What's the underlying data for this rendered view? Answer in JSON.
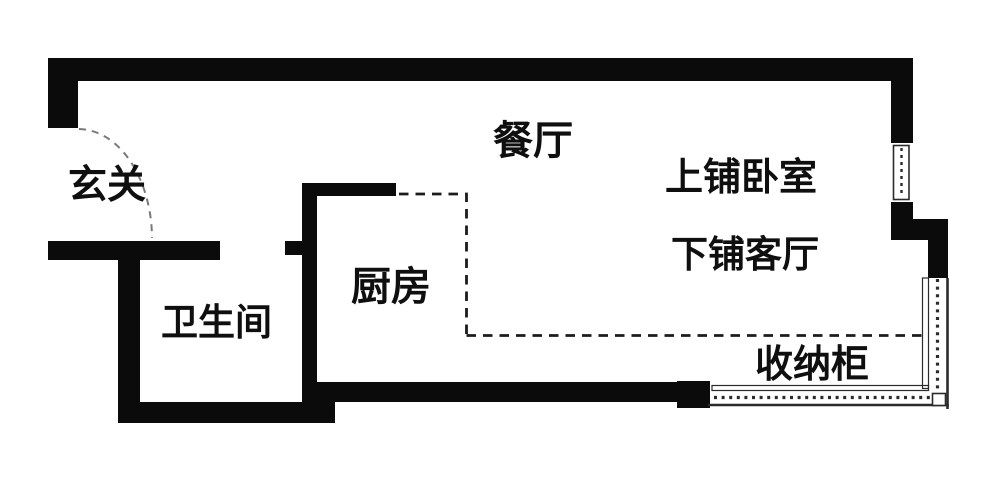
{
  "plan_title": "studio-apartment-floor-plan",
  "colors": {
    "background": "#ffffff",
    "wall": "#0b0b0b",
    "window_line": "#2b2b2b",
    "dash_line": "#1c1c1c",
    "door_arc": "#7a7a7a",
    "text": "#0f0f0f"
  },
  "rooms": {
    "entry": {
      "label": "玄关"
    },
    "dining": {
      "label": "餐厅"
    },
    "kitchen": {
      "label": "厨房"
    },
    "bathroom": {
      "label": "卫生间"
    },
    "bunk_bedroom": {
      "label": "上铺卧室"
    },
    "bunk_living": {
      "label": "下铺客厅"
    },
    "storage_cabinet": {
      "label": "收纳柜"
    }
  }
}
